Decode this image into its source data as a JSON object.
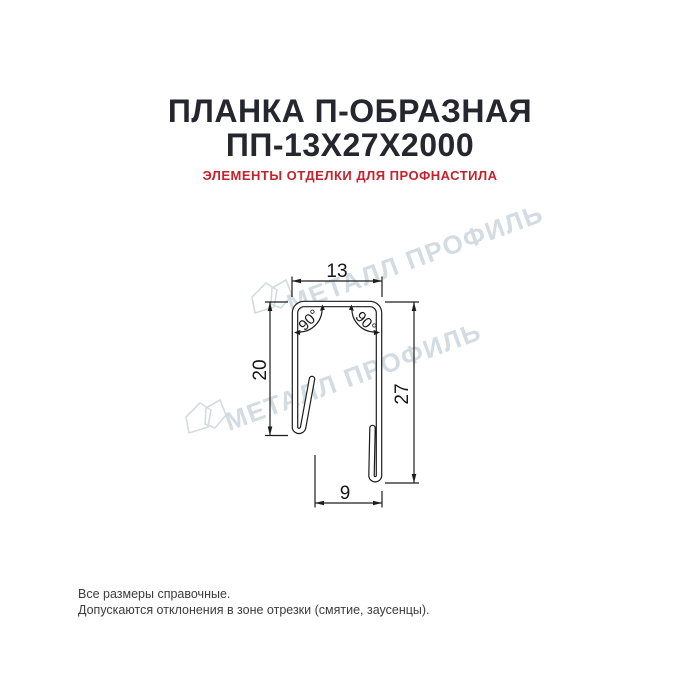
{
  "header": {
    "title_line1": "ПЛАНКА П-ОБРАЗНАЯ",
    "title_line2": "ПП-13Х27Х2000",
    "subtitle": "ЭЛЕМЕНТЫ ОТДЕЛКИ ДЛЯ ПРОФНАСТИЛА"
  },
  "drawing": {
    "dim_top_width": "13",
    "dim_left_height": "20",
    "dim_right_height": "27",
    "dim_bottom_width": "9",
    "angle_left": "90°",
    "angle_right": "90°"
  },
  "watermark": {
    "text": "МЕТАЛЛ ПРОФИЛЬ"
  },
  "footer": {
    "line1": "Все размеры справочные.",
    "line2": "Допускаются отклонения в зоне отрезки (смятие, заусенцы)."
  },
  "colors": {
    "title": "#26262e",
    "accent_red": "#c5222c",
    "drawing_line": "#1d1d1f",
    "watermark": "#d3dce2",
    "background": "#ffffff"
  }
}
